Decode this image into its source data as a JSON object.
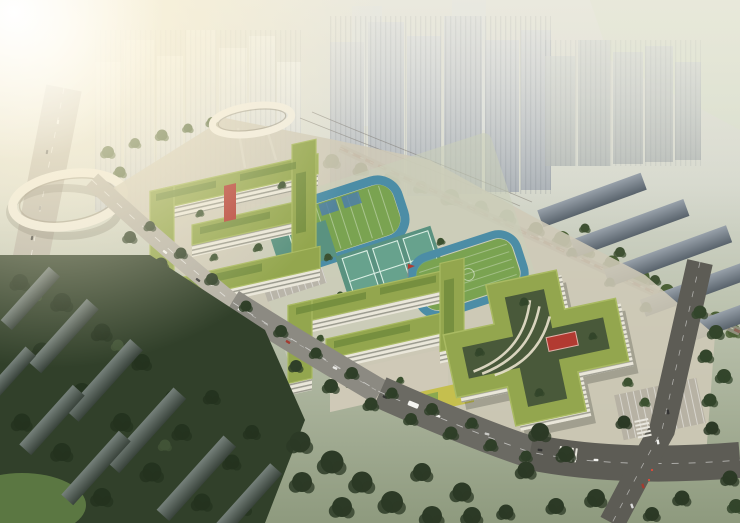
{
  "meta": {
    "image_type": "architectural aerial rendering",
    "subject": "Bird's-eye perspective rendering of a school campus with yellow-green roofed zigzag classroom buildings, a cross-shaped building with rooftop garden, a running track, tennis courts and sports fields, surrounded by high-rise towers, tree-lined boulevards, a highway and two circular pedestrian ring bridges",
    "lighting": "hazy warm sunlight glaring from the upper left",
    "visible_text": ""
  },
  "palette": {
    "sky_haze": "#e4e3d9",
    "glare_warm": "#fff6da",
    "tower_gray": "#bcc2c8",
    "slab_gray": "#6b7681",
    "tree_dark": "#2f3f28",
    "tree_mid": "#4c6136",
    "roof_green": "#93a64e",
    "facade_white": "#eae7da",
    "window_dark": "#585b50",
    "field_green": "#7aa351",
    "track_teal": "#4c8da6",
    "court_teal": "#5a9280",
    "court_line": "#d9eee3",
    "accent_red": "#b23a31",
    "road_light": "#b5b1a6",
    "road_dark": "#5d5c55",
    "pavement": "#cfc9b7",
    "playground_yellow": "#c5bf4e"
  },
  "scene": {
    "elements": [
      {
        "name": "background-towers",
        "description": "hazy high-rise residential towers across the top"
      },
      {
        "name": "left-ring-bridge",
        "description": "large elliptical pedestrian ring bridge over highway, left edge"
      },
      {
        "name": "top-ring-bridge",
        "description": "smaller circular pedestrian ring bridge behind school"
      },
      {
        "name": "left-school-complex",
        "description": "zigzag multi-storey school building with green roofs and red stair tower"
      },
      {
        "name": "sports-fields",
        "description": "striped green field with teal track, tennis courts, second field"
      },
      {
        "name": "lower-school-complex",
        "description": "second zigzag building with plaza and yellow playground"
      },
      {
        "name": "cross-building",
        "description": "plus-shaped building with green roof band, inner garden courtyard and red pavilion"
      },
      {
        "name": "boulevard",
        "description": "tree-lined avenue running diagonally with traffic"
      },
      {
        "name": "residential-slabs",
        "description": "dark mid-rise slab blocks among forest, lower left"
      },
      {
        "name": "intersection",
        "description": "road crossing with zebra stripes, lower right"
      }
    ]
  }
}
